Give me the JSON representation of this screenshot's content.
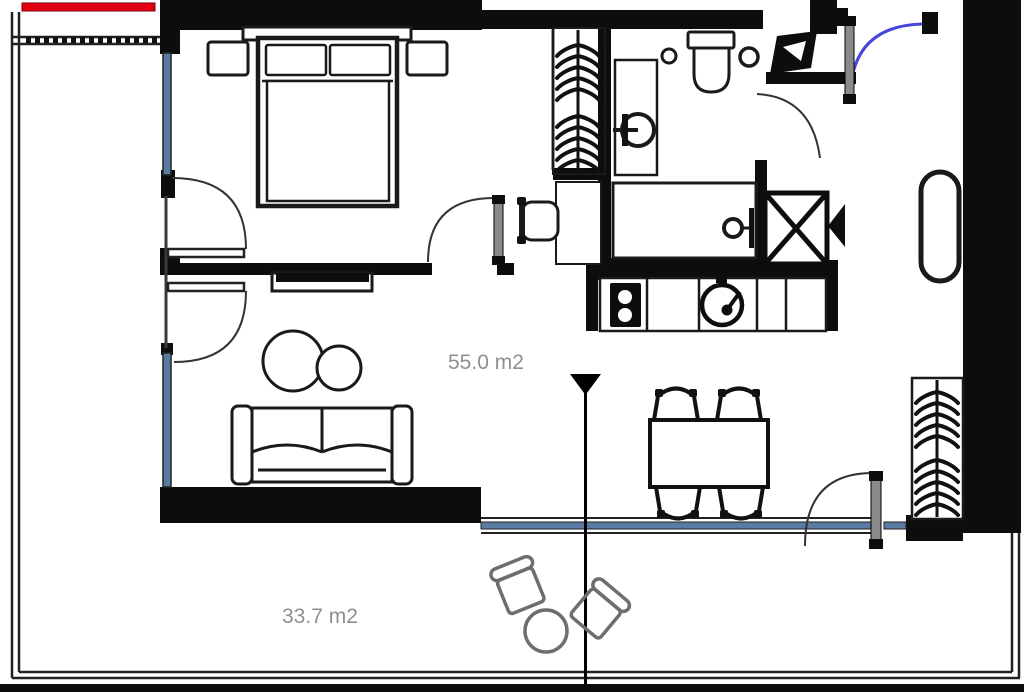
{
  "document": {
    "type": "apartment-floor-plan"
  },
  "labels": {
    "main_area": "55.0 m2",
    "balcony_area": "33.7 m2"
  },
  "colors": {
    "wall": "#0d0d0d",
    "furniture_stroke": "#1a1a1a",
    "window_glass": "#5a7ba3",
    "entry_door_arc": "#4747e0",
    "red_marker": "#e60013",
    "area_text": "#8f8f8f",
    "balcony_furniture": "#6e6e6e"
  }
}
